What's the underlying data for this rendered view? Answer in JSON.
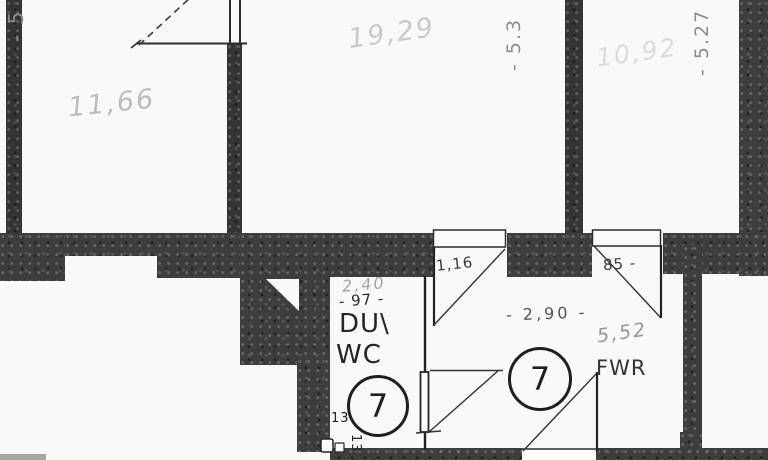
{
  "plan": {
    "rooms": {
      "top_left": {
        "area": "11,66"
      },
      "top_middle": {
        "area": "19,29"
      },
      "top_right": {
        "area": "10,92"
      },
      "shower_wc": {
        "line1": "DU\\",
        "line2": "WC",
        "area": "2,40",
        "width_dim": "- 97 -",
        "unit": "7"
      },
      "hallway": {
        "label": "FWR",
        "area": "5,52",
        "width_dim": "- 2,90 -",
        "unit": "7"
      }
    },
    "vertical_dims": {
      "left": "- 5",
      "middle": "- 5.3",
      "right": "- 5.27"
    },
    "door_dims": {
      "door_a": "1,16",
      "door_b": "85 -"
    },
    "wall_thickness": {
      "a": "13",
      "b": "13"
    }
  }
}
